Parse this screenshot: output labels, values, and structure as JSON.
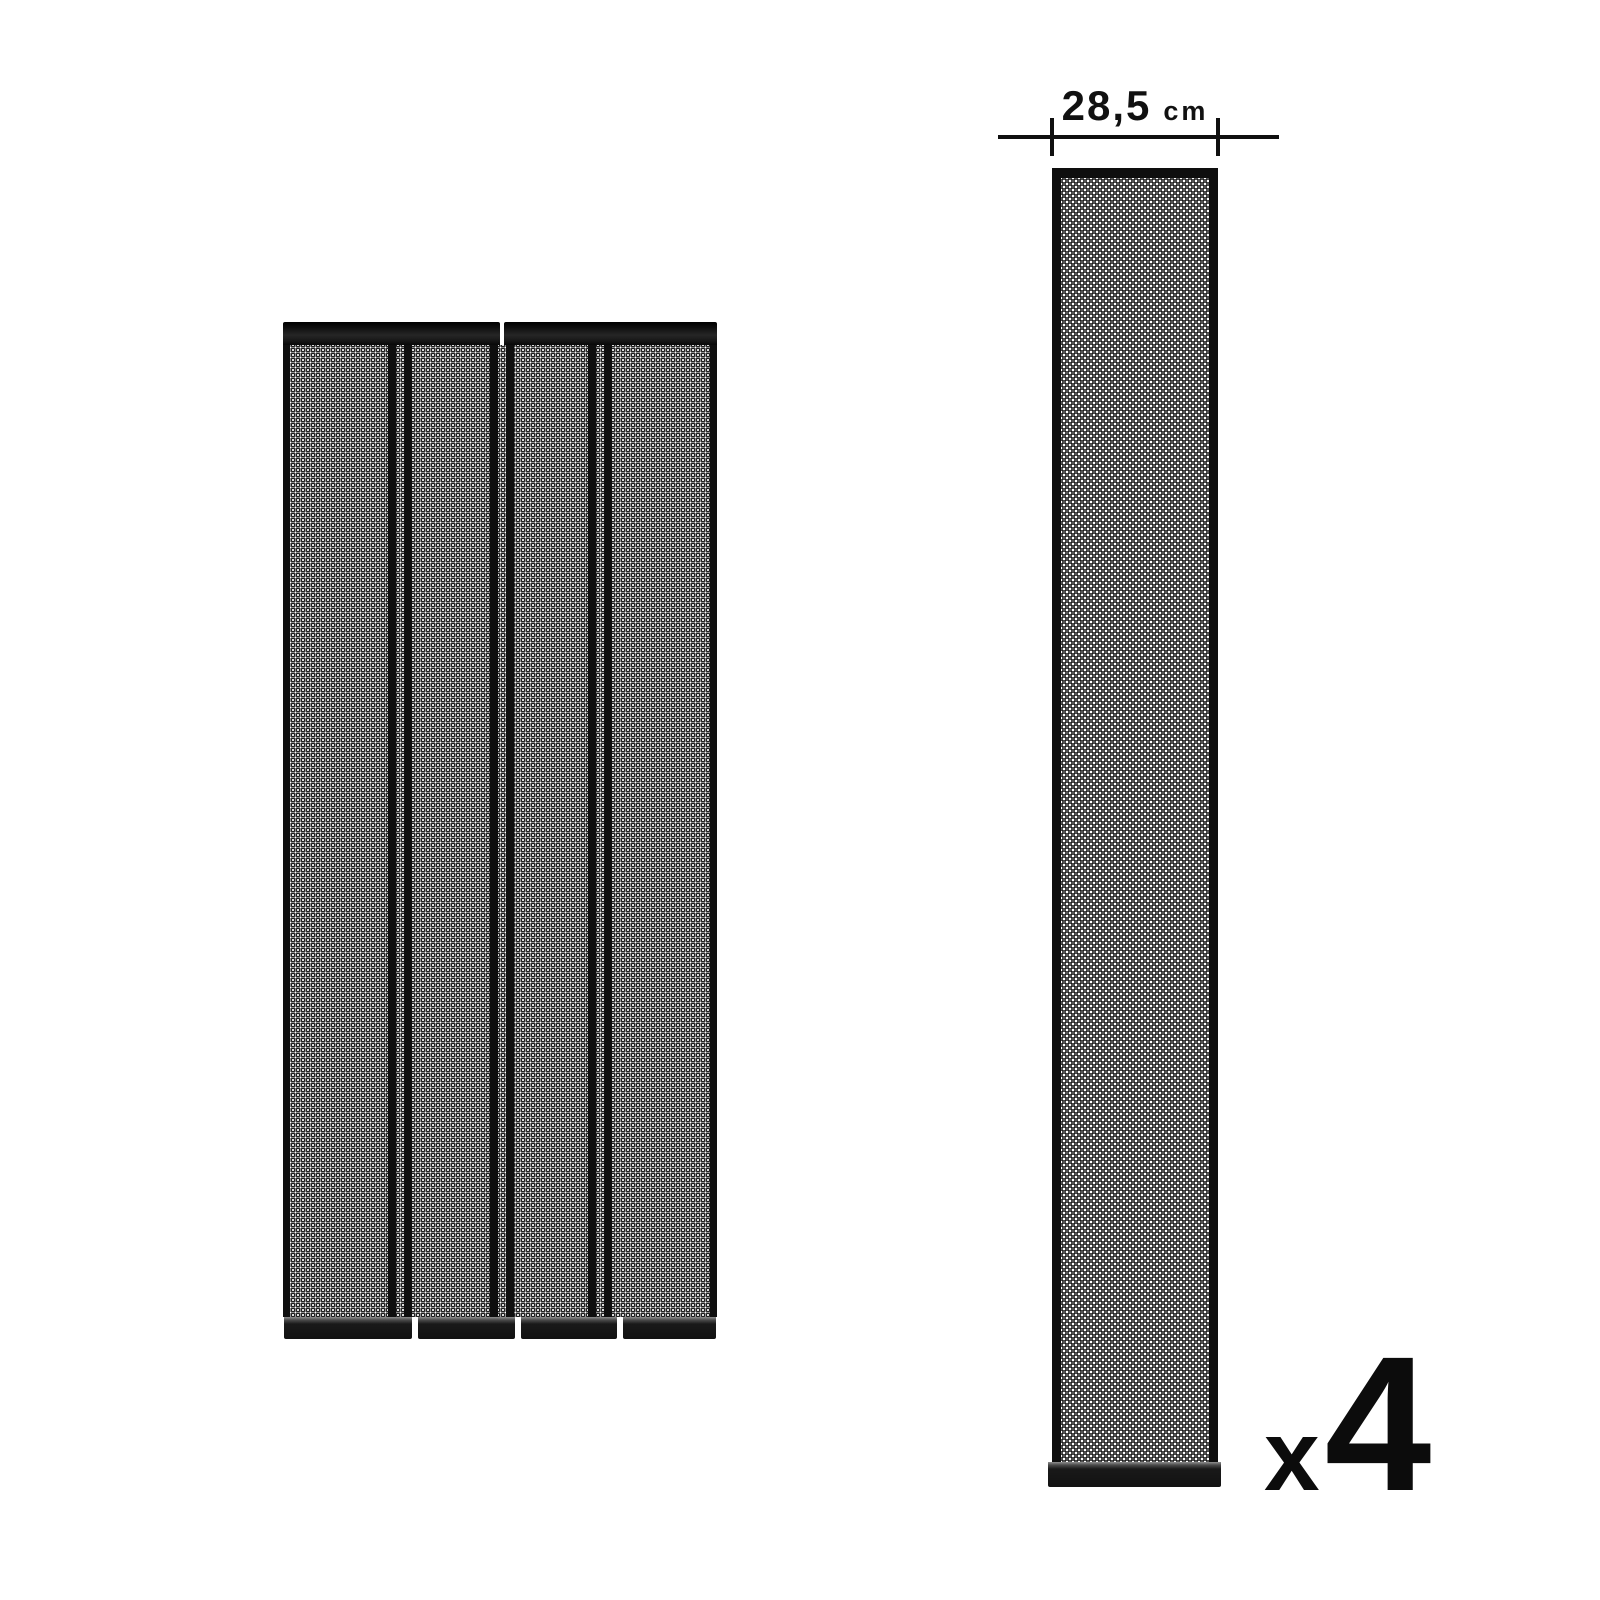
{
  "page": {
    "background_color": "#ffffff"
  },
  "colors": {
    "frame_black": "#0e0e0e",
    "mesh_line": "#1f1f1f",
    "mesh_background": "#fbfbfb",
    "text_black": "#111111"
  },
  "curtain": {
    "description": "door curtain assembled from four vertical mesh strips",
    "panel_count": 4
  },
  "strip": {
    "description": "single mesh strip with weighted bottom bar"
  },
  "dimension": {
    "value": "28,5",
    "unit": "cm"
  },
  "quantity": {
    "times_symbol": "x",
    "count": "4"
  }
}
